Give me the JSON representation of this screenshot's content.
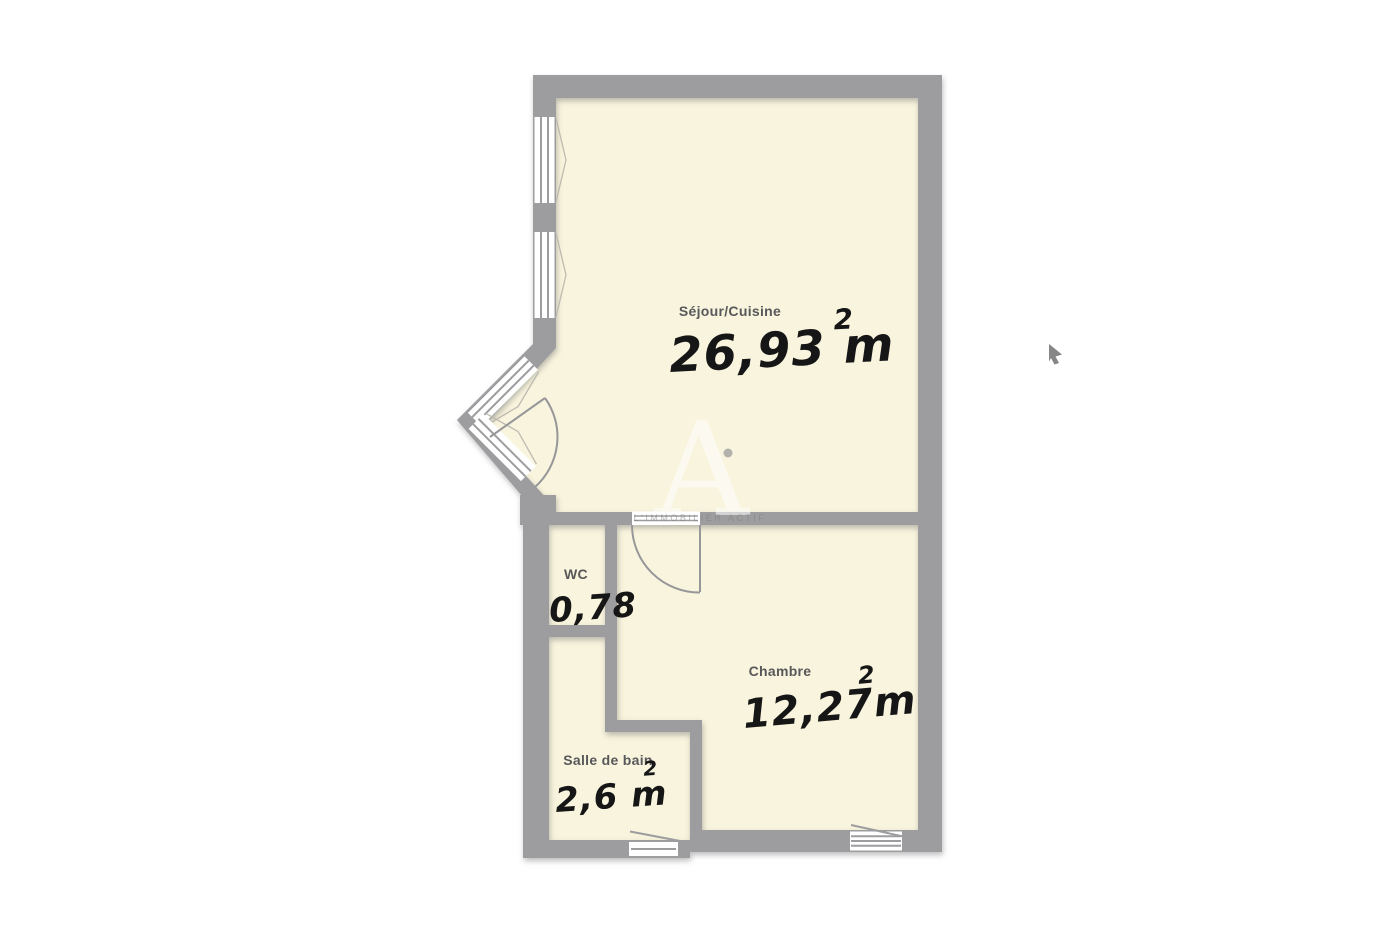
{
  "plan": {
    "type": "floorplan",
    "watermark": {
      "logo": "A",
      "text": "L'IMMOBILIER ACTIF"
    },
    "colors": {
      "wall": "#9d9da0",
      "floor": "#f8f4dd",
      "label": "#58585a",
      "handwriting": "#161616",
      "background": "#ffffff",
      "cursor": "#868686"
    },
    "rooms": [
      {
        "id": "sejour-cuisine",
        "label": "Séjour/Cuisine",
        "area_value": "26,93 m",
        "area_sup": "2"
      },
      {
        "id": "wc",
        "label": "WC",
        "area_value": "0,78",
        "area_sup": ""
      },
      {
        "id": "chambre",
        "label": "Chambre",
        "area_value": "12,27m",
        "area_sup": "2"
      },
      {
        "id": "salle-de-bain",
        "label": "Salle de bain",
        "area_value": "2,6 m",
        "area_sup": "2"
      }
    ]
  }
}
